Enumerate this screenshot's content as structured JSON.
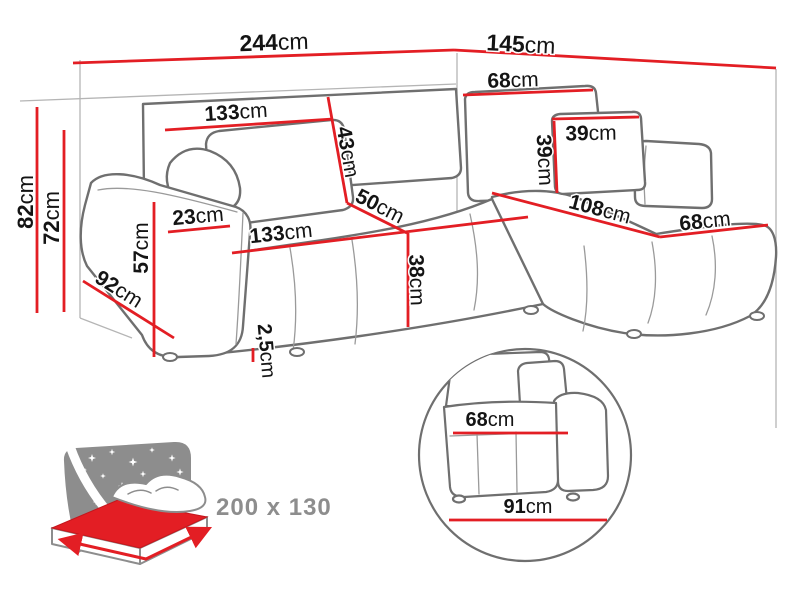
{
  "colors": {
    "red": "#e31e24",
    "outline": "#6f6f6f",
    "light_outline": "#b5b5b5",
    "text": "#141414",
    "icon_gray": "#8d8d8d",
    "background": "#ffffff"
  },
  "bed_icon": {
    "size_label": "200 x 130"
  },
  "dimensions": [
    {
      "id": "width-total",
      "num": "244",
      "unit": "cm",
      "line": [
        73,
        63,
        454,
        50
      ],
      "label": {
        "x": 274,
        "y": 42,
        "rot": -2,
        "size": 23
      }
    },
    {
      "id": "depth-total",
      "num": "145",
      "unit": "cm",
      "line": [
        454,
        50,
        776,
        68
      ],
      "label": {
        "x": 521,
        "y": 44,
        "rot": 3,
        "size": 23
      }
    },
    {
      "id": "height-total",
      "num": "82",
      "unit": "cm",
      "line": [
        37,
        107,
        37,
        313
      ],
      "label": {
        "x": 25,
        "y": 202,
        "rot": -90,
        "size": 22
      }
    },
    {
      "id": "height-backrest",
      "num": "72",
      "unit": "cm",
      "line": [
        64,
        130,
        64,
        312
      ],
      "label": {
        "x": 51,
        "y": 218,
        "rot": -90,
        "size": 22
      }
    },
    {
      "id": "backrest-width",
      "num": "133",
      "unit": "cm",
      "line": [
        165,
        130,
        333,
        119
      ],
      "label": {
        "x": 236,
        "y": 112,
        "rot": -4,
        "size": 21
      }
    },
    {
      "id": "backrest-right-width",
      "num": "68",
      "unit": "cm",
      "line": [
        463,
        95,
        593,
        90
      ],
      "label": {
        "x": 513,
        "y": 80,
        "rot": -2,
        "size": 21
      }
    },
    {
      "id": "backrest-depth",
      "num": "43",
      "unit": "cm",
      "line": [
        328,
        97,
        347,
        203
      ],
      "label": {
        "x": 348,
        "y": 152,
        "rot": 80,
        "size": 21
      }
    },
    {
      "id": "seat-depth",
      "num": "50",
      "unit": "cm",
      "line": [
        347,
        203,
        407,
        233
      ],
      "label": {
        "x": 380,
        "y": 206,
        "rot": 27,
        "size": 21
      }
    },
    {
      "id": "armrest-width",
      "num": "23",
      "unit": "cm",
      "line": [
        168,
        232,
        230,
        226
      ],
      "label": {
        "x": 198,
        "y": 216,
        "rot": -5,
        "size": 21
      }
    },
    {
      "id": "seat-width",
      "num": "133",
      "unit": "cm",
      "line": [
        232,
        253,
        528,
        217
      ],
      "label": {
        "x": 281,
        "y": 233,
        "rot": -6,
        "size": 21
      }
    },
    {
      "id": "armrest-height",
      "num": "57",
      "unit": "cm",
      "line": [
        154,
        202,
        154,
        357
      ],
      "label": {
        "x": 141,
        "y": 248,
        "rot": -90,
        "size": 21
      }
    },
    {
      "id": "armrest-depth",
      "num": "92",
      "unit": "cm",
      "line": [
        83,
        281,
        174,
        338
      ],
      "label": {
        "x": 119,
        "y": 289,
        "rot": 32,
        "size": 21
      }
    },
    {
      "id": "seat-height",
      "num": "38",
      "unit": "cm",
      "line": [
        408,
        233,
        408,
        327
      ],
      "label": {
        "x": 417,
        "y": 280,
        "rot": 88,
        "size": 21
      }
    },
    {
      "id": "leg-height",
      "num": "2,5",
      "unit": "cm",
      "line": [
        253,
        348,
        253,
        362
      ],
      "label": {
        "x": 266,
        "y": 351,
        "rot": 85,
        "size": 20
      }
    },
    {
      "id": "pillow-width",
      "num": "39",
      "unit": "cm",
      "line": [
        552,
        119,
        639,
        117
      ],
      "label": {
        "x": 591,
        "y": 133,
        "rot": -1,
        "size": 21
      }
    },
    {
      "id": "pillow-height",
      "num": "39",
      "unit": "cm",
      "line": [
        554,
        121,
        557,
        193
      ],
      "label": {
        "x": 545,
        "y": 160,
        "rot": 87,
        "size": 21
      }
    },
    {
      "id": "chaise-length",
      "num": "108",
      "unit": "cm",
      "line": [
        492,
        193,
        660,
        237
      ],
      "label": {
        "x": 600,
        "y": 209,
        "rot": 15,
        "size": 21
      }
    },
    {
      "id": "chaise-width",
      "num": "68",
      "unit": "cm",
      "line": [
        660,
        237,
        768,
        225
      ],
      "label": {
        "x": 705,
        "y": 221,
        "rot": -6,
        "size": 21
      }
    },
    {
      "id": "detail-seat-width",
      "num": "68",
      "unit": "cm",
      "line": [
        453,
        433,
        568,
        433
      ],
      "label": {
        "x": 490,
        "y": 420,
        "rot": 0,
        "size": 20
      }
    },
    {
      "id": "detail-base-width",
      "num": "91",
      "unit": "cm",
      "line": [
        449,
        520,
        607,
        520
      ],
      "label": {
        "x": 528,
        "y": 507,
        "rot": 0,
        "size": 20
      }
    }
  ],
  "stars": [
    [
      92,
      458,
      1.0
    ],
    [
      112,
      452,
      0.8
    ],
    [
      133,
      462,
      1.1
    ],
    [
      152,
      450,
      0.7
    ],
    [
      172,
      458,
      0.9
    ],
    [
      103,
      476,
      0.7
    ],
    [
      122,
      486,
      1.0
    ],
    [
      143,
      474,
      0.8
    ],
    [
      163,
      486,
      0.7
    ],
    [
      180,
      472,
      0.9
    ],
    [
      96,
      502,
      0.8
    ],
    [
      140,
      494,
      0.5
    ],
    [
      158,
      503,
      0.9
    ],
    [
      178,
      492,
      0.6
    ],
    [
      85,
      470,
      0.5
    ],
    [
      170,
      507,
      0.5
    ]
  ]
}
